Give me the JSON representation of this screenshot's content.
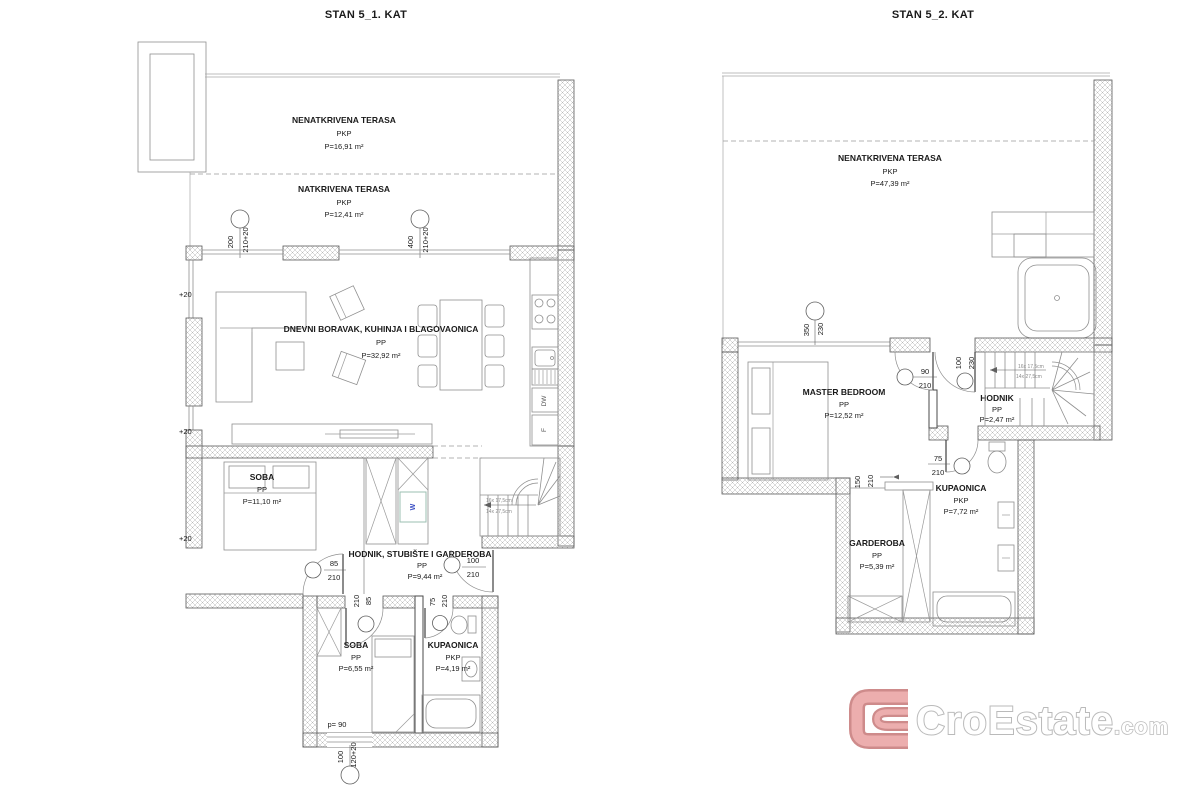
{
  "plan1": {
    "title": "STAN 5_1. KAT",
    "terrace_open": {
      "name": "NENATKRIVENA TERASA",
      "code": "PKP",
      "area": "P=16,91 m²"
    },
    "terrace_covered": {
      "name": "NATKRIVENA TERASA",
      "code": "PKP",
      "area": "P=12,41 m²"
    },
    "living": {
      "name": "DNEVNI BORAVAK, KUHINJA I BLAGOVAONICA",
      "code": "PP",
      "area": "P=32,92 m²"
    },
    "bedroom1": {
      "name": "SOBA",
      "code": "PP",
      "area": "P=11,10 m²"
    },
    "hall": {
      "name": "HODNIK, STUBIŠTE I GARDEROBA",
      "code": "PP",
      "area": "P=9,44 m²"
    },
    "bedroom2": {
      "name": "SOBA",
      "code": "PP",
      "area": "P=6,55 m²"
    },
    "bath": {
      "name": "KUPAONICA",
      "code": "PKP",
      "area": "P=4,19 m²"
    },
    "dims": {
      "win1w": "200",
      "win1h": "210+20",
      "win2w": "400",
      "win2h": "210+20",
      "door1w": "85",
      "door1h": "210",
      "door2w": "100",
      "door2h": "210",
      "door3w": "85",
      "door3h": "210",
      "door4w": "75",
      "door4h": "210",
      "win3w": "100",
      "win3h": "120+20",
      "parapet": "p= 90"
    },
    "levels": [
      "+20",
      "+20",
      "+20"
    ],
    "appliances": {
      "washer": "W",
      "dishwasher": "DW",
      "fridge": "F"
    },
    "stairs": {
      "line1": "16x 17,5cm",
      "line2": "14x 27,5cm"
    }
  },
  "plan2": {
    "title": "STAN 5_2. KAT",
    "terrace": {
      "name": "NENATKRIVENA TERASA",
      "code": "PKP",
      "area": "P=47,39 m²"
    },
    "master": {
      "name": "MASTER BEDROOM",
      "code": "PP",
      "area": "P=12,52 m²"
    },
    "hall": {
      "name": "HODNIK",
      "code": "PP",
      "area": "P=2,47 m²"
    },
    "bath": {
      "name": "KUPAONICA",
      "code": "PKP",
      "area": "P=7,72 m²"
    },
    "wardrobe": {
      "name": "GARDEROBA",
      "code": "PP",
      "area": "P=5,39 m²"
    },
    "dims": {
      "winw": "350",
      "winh": "230",
      "door1w": "90",
      "door1h": "210",
      "door2w": "100",
      "door2h": "230",
      "door3w": "75",
      "door3h": "210",
      "openw": "150",
      "openh": "210"
    },
    "stairs": {
      "line1": "16x 17,5cm",
      "line2": "14x 27,5cm"
    }
  },
  "logo": {
    "brand": "CroEstate",
    "tld": ".com"
  },
  "colors": {
    "logo_red": "#eba6a6",
    "logo_red_dark": "#c97f7f",
    "logo_gray": "#b3b3b3",
    "washer_blue": "#3b4fc4"
  }
}
